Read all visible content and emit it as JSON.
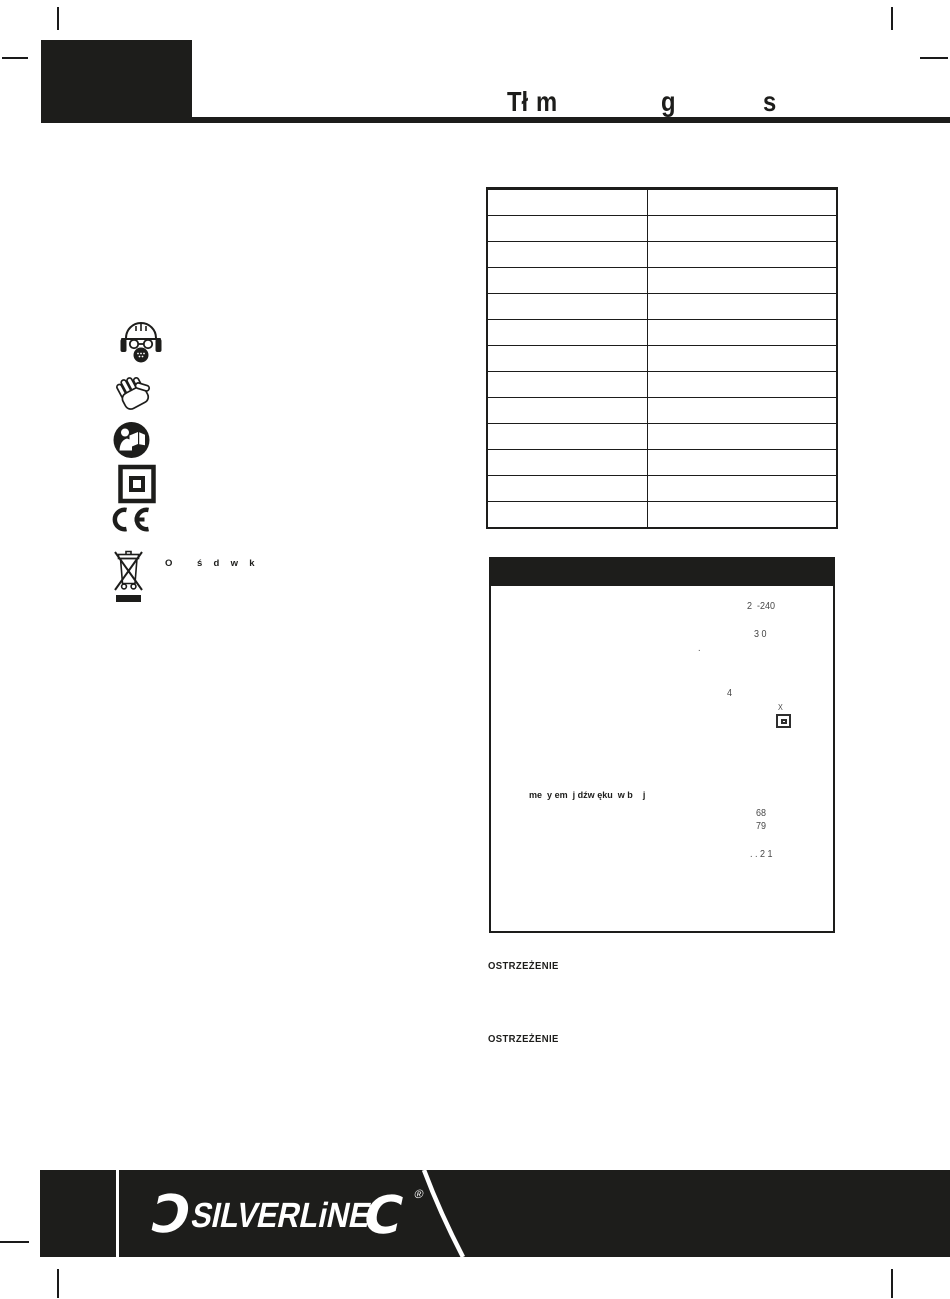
{
  "colors": {
    "ink": "#1d1d1b",
    "paper": "#ffffff"
  },
  "header": {
    "title_fragments": [
      {
        "text": "Tł"
      },
      {
        "text": "m"
      },
      {
        "text": "g"
      },
      {
        "text": "s"
      }
    ]
  },
  "safety_icons": [
    {
      "name": "ppe-icon"
    },
    {
      "name": "gloves-icon"
    },
    {
      "name": "read-manual-icon"
    },
    {
      "name": "double-insulated-icon"
    },
    {
      "name": "ce-mark-icon"
    },
    {
      "name": "weee-bin-icon"
    }
  ],
  "environment_note": {
    "fragments": [
      {
        "text": "O"
      },
      {
        "text": "ś  d  w  k"
      }
    ]
  },
  "spec_table": {
    "rows": 13,
    "columns": 2
  },
  "spec_box": {
    "fragments": [
      {
        "text": "2  -240"
      },
      {
        "text": "3 0"
      },
      {
        "text": "."
      },
      {
        "text": "4"
      },
      {
        "text": "X"
      },
      {
        "text": "me  y em  j dźw ęku  w b    j"
      },
      {
        "text": "68"
      },
      {
        "text": "79"
      },
      {
        "text": ". . 2 1"
      }
    ]
  },
  "warnings": [
    {
      "label": "OSTRZEŻENIE"
    },
    {
      "label": "OSTRZEŻENIE"
    }
  ],
  "footer": {
    "left_wrench": "Ɔ",
    "brand": "SILVERLiNE",
    "right_wrench": "C",
    "registered": "®"
  }
}
